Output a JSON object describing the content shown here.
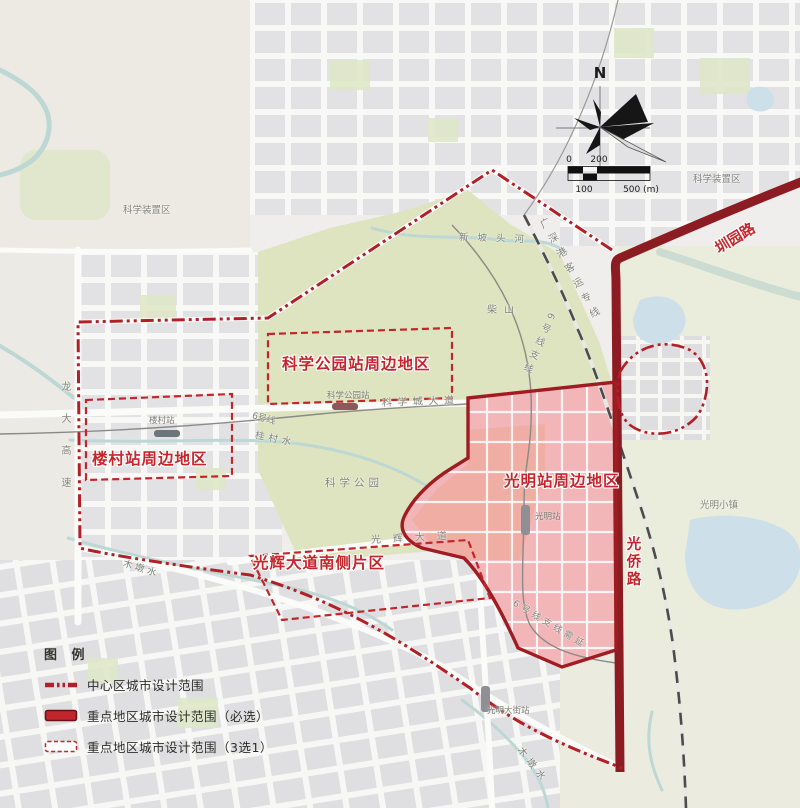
{
  "compass": {
    "north": "N"
  },
  "scale_bar": {
    "zero": "0",
    "two_hundred": "200",
    "one_hundred": "100",
    "five_hundred": "500 (m)"
  },
  "legend": {
    "title": "图 例",
    "items": [
      {
        "label": "中心区城市设计范围",
        "swatch": "dashdot-line"
      },
      {
        "label": "重点地区城市设计范围（必选）",
        "swatch": "solid-red-rect"
      },
      {
        "label": "重点地区城市设计范围（3选1）",
        "swatch": "dashed-red-rect"
      }
    ]
  },
  "map": {
    "districts": {
      "kexue_park_station": "科学公园站周边地区",
      "loucun_station": "楼村站周边地区",
      "guangming_station": "光明站周边地区",
      "guanghui_south": "光辉大道南侧片区"
    },
    "roads": {
      "zhenyuan_road": "圳园路",
      "guangqiao_road": "光侨路",
      "kexuecheng_avenue": "科学城大道",
      "guanghui_avenue": "光辉大道",
      "longda_expressway": "龙大高速"
    },
    "stations": {
      "kexue_park": "科学公园站",
      "loucun": "楼村站",
      "guangming": "光明站",
      "guangming_street": "光明大街站"
    },
    "rail_lines": {
      "gsg_rail": "广深港客运专线",
      "line6": "6号线",
      "line6_branch": "6号线支线",
      "line6_branch_note": "6号线支线需延"
    },
    "places": {
      "science_facility_west": "科学装置区",
      "science_facility_east": "科学装置区",
      "chaishan_hill": "柴山",
      "science_park": "科学公园",
      "guangming_town": "光明小镇"
    },
    "waters": {
      "xinpotou_river": "新坡头河",
      "guicun_stream": "桂村水",
      "mudun_stream_west": "木墩水",
      "mudun_stream_south": "木墩水"
    }
  },
  "colors": {
    "district_label": "#c4262c",
    "boundary_dashdot": "#b21f26",
    "key_area_outline": "#a01c22",
    "key_area_fill": "#f2b5b8",
    "main_road": "#8c1c21",
    "park_green": "#dde4bf",
    "water": "#bdd8d4",
    "lake": "#cddfe9"
  }
}
